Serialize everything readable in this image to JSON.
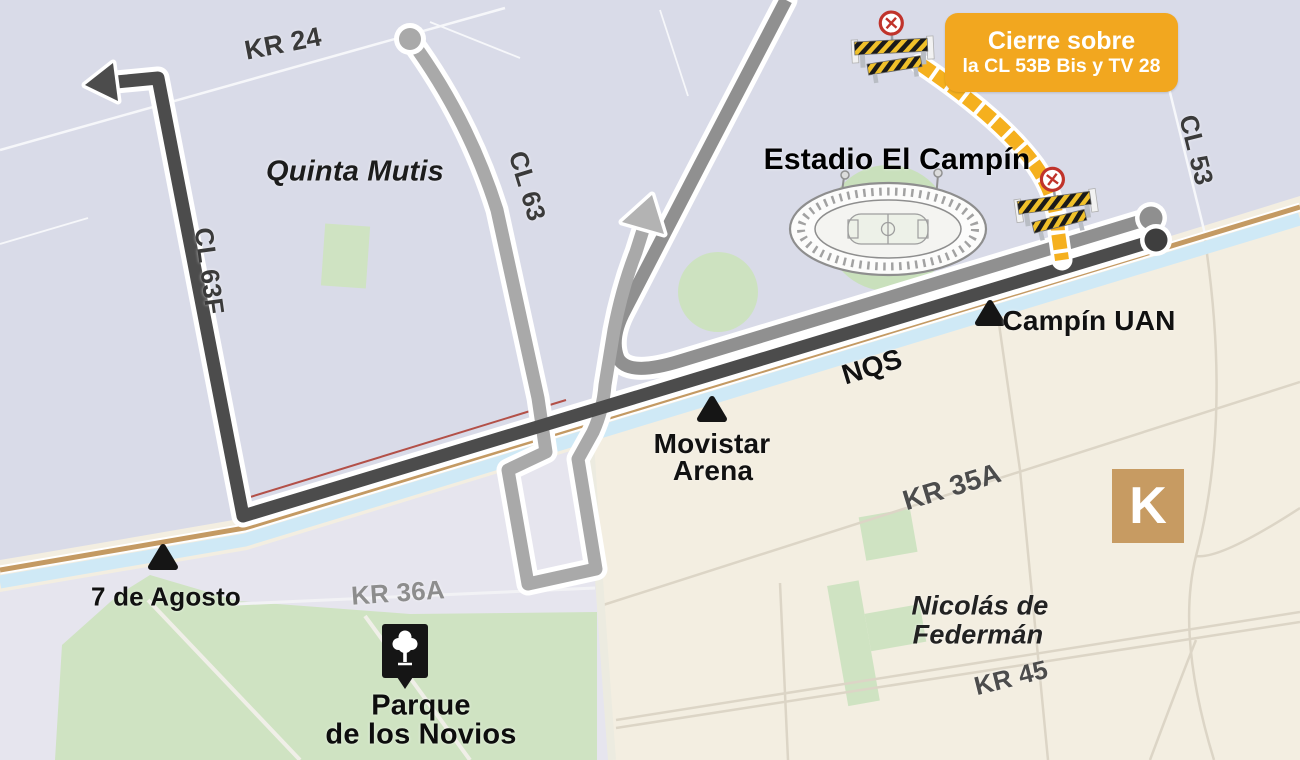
{
  "colors": {
    "bg_north": "#d9dbe8",
    "bg_south": "#f3eee1",
    "bg_southwest": "#e6e5ee",
    "park_green": "#cfe3c2",
    "canal_blue": "#cfe9f6",
    "road_tan": "#c49a63",
    "rail_red": "#b35048",
    "route_dark": "#4c4c4c",
    "route_light": "#a9a9a9",
    "route_mid": "#909090",
    "arrow_light": "#b3b3b3",
    "street_north": "#f6f7fa",
    "street_south": "#dcd5c6",
    "closure_yellow": "#f5b01e",
    "barrier_yellow": "#f0c02a",
    "callout_bg": "#f2a71f",
    "callout_text": "#ffffff",
    "k_bg": "#c79b62",
    "marker_black": "#151515",
    "sign_red": "#c0332b"
  },
  "callout": {
    "line1": "Cierre sobre",
    "line2": "la CL 53B Bis y TV 28"
  },
  "roads": {
    "kr24": "KR 24",
    "cl63": "CL 63",
    "cl63f": "CL 63F",
    "cl53": "CL 53",
    "nqs": "NQS",
    "kr35a": "KR 35A",
    "kr45": "KR 45",
    "kr36a": "KR 36A"
  },
  "places": {
    "quinta_mutis": "Quinta Mutis",
    "estadio": "Estadio El Campín",
    "campin_uan": "Campín UAN",
    "movistar1": "Movistar",
    "movistar2": "Arena",
    "nicolas1": "Nicolás de",
    "nicolas2": "Federmán",
    "siete_agosto": "7 de Agosto",
    "parque1": "Parque",
    "parque2": "de los Novios",
    "k": "K"
  }
}
